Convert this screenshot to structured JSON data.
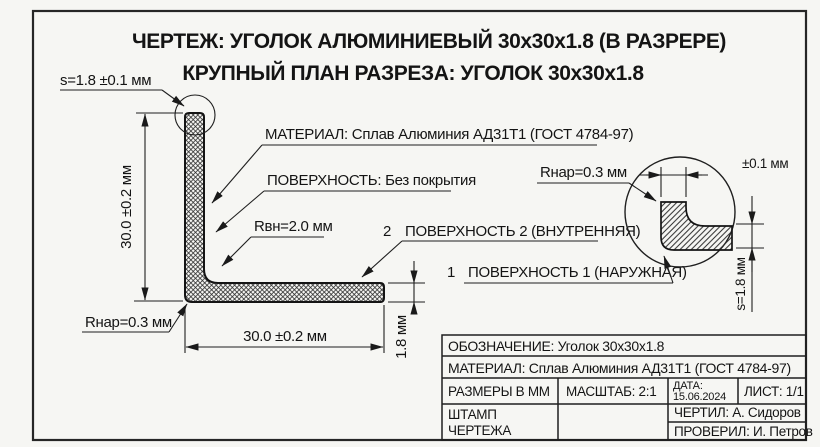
{
  "colors": {
    "paper": "#f6f6f3",
    "ink": "#1a1a1a"
  },
  "header": {
    "title": "ЧЕРТЕЖ: УГОЛОК АЛЮМИНИЕВЫЙ 30х30х1.8 (В РАЗРЕРЕ)",
    "subtitle": "КРУПНЫЙ ПЛАН РАЗРЕЗА: УГОЛОК 30х30х1.8"
  },
  "callouts": {
    "thickness": "s=1.8 ±0.1 мм",
    "material": "МАТЕРИАЛ: Сплав Алюминия АД31Т1 (ГОСТ 4784-97)",
    "coating": "ПОВЕРХНОСТЬ: Без покрытия",
    "inner_radius": "Rвн=2.0 мм",
    "outer_radius_main": "Rнар=0.3 мм",
    "outer_radius_detail": "Rнар=0.3 мм",
    "surface2_num": "2",
    "surface2": "ПОВЕРХНОСТЬ 2 (ВНУТРЕННЯЯ)",
    "surface1_num": "1",
    "surface1": "ПОВЕРХНОСТЬ 1 (НАРУЖНАЯ)"
  },
  "dims": {
    "height": "30.0 ±0.2 мм",
    "width": "30.0 ±0.2 мм",
    "thickness": "1.8 мм",
    "detail_tolerance": "±0.1 мм",
    "detail_thickness": "s=1.8 мм"
  },
  "title_block": {
    "designation": "ОБОЗНАЧЕНИЕ:  Уголок 30х30х1.8",
    "material": "МАТЕРИАЛ:  Сплав Алюминия АД31Т1 (ГОСТ 4784-97)",
    "units": "РАЗМЕРЫ В ММ",
    "scale": "МАСШТАБ: 2:1",
    "date_label": "ДАТА:",
    "date_value": "15.06.2024",
    "sheet": "ЛИСТ: 1/1",
    "stamp_line1": "ШТАМП",
    "stamp_line2": "ЧЕРТЕЖА",
    "drawn_by": "ЧЕРТИЛ: А. Сидоров",
    "checked_by": "ПРОВЕРИЛ: И. Петров"
  }
}
